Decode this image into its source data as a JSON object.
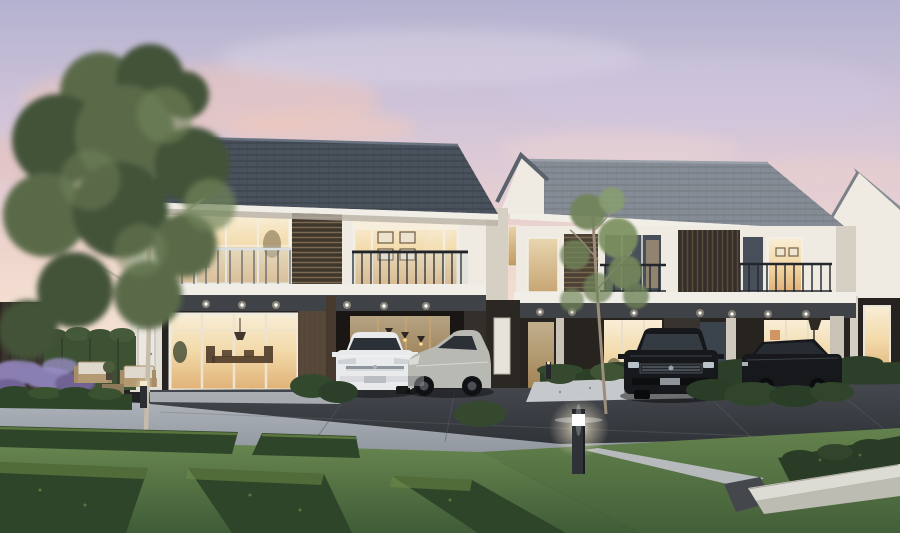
{
  "canvas": {
    "width": 900,
    "height": 533
  },
  "scene": {
    "type": "architectural-render",
    "setting": "Modern two-storey townhouse development at dusk",
    "sky": "pastel lavender-to-pink sunset with soft clouds",
    "buildings": [
      {
        "id": "building-1",
        "position": "left-foreground",
        "roof": "dark slate tiled gable",
        "floors": 2,
        "features": [
          "glass balustrade balcony",
          "timber louver screens",
          "lit upper windows",
          "gallery wall with four picture frames",
          "sliding glass doors with lit dining room",
          "carport with two cars",
          "white side door"
        ]
      },
      {
        "id": "building-2",
        "position": "right-background",
        "roof": "grey tiled gable",
        "floors": 2,
        "features": [
          "dark metal balcony railings",
          "vertical louver panel",
          "lit ground-floor glazing with floor lamp",
          "white gable end with small lit window"
        ]
      },
      {
        "id": "building-3",
        "position": "far-right-edge",
        "roof": "grey gable",
        "floors": 2,
        "features": [
          "white gable wall",
          "dark carport",
          "lit entry door"
        ]
      }
    ],
    "vehicles": [
      {
        "id": "white-sedan",
        "color": "white",
        "location": "building-1 carport",
        "orientation": "front"
      },
      {
        "id": "silver-hatchback",
        "color": "silver",
        "location": "building-1 carport",
        "orientation": "three-quarter front"
      },
      {
        "id": "black-suv",
        "color": "black",
        "location": "building-2 driveway",
        "orientation": "front"
      },
      {
        "id": "black-sedan",
        "color": "black",
        "location": "building-2 driveway",
        "orientation": "side"
      }
    ],
    "landscape": [
      "large deciduous tree",
      "slender young tree",
      "ivy hedge wall",
      "dark timber fence",
      "lavender shrubs",
      "timber garden bench set with coffee table",
      "low clipped hedges",
      "geometric hedge parterre with lawn paths",
      "gravel bed with shrubs",
      "white concrete planter",
      "concrete footpath",
      "lit bollard lamp",
      "small bollard lights",
      "recessed soffit downlights"
    ]
  },
  "palette": {
    "sky-top": "#b4b2d0",
    "sky-horizon": "#f4e0d2",
    "cloud-pink": "#eec6bb",
    "roof-dark": "#4a525e",
    "roof-light": "#868c95",
    "fascia": "#f1eee7",
    "wall-white": "#efebe2",
    "wall-shade": "#d6d0c4",
    "panel-dark": "#37332e",
    "panel-brown": "#5c4c3c",
    "window-warm": "#f2d9a8",
    "glass-cool": "#47505a",
    "canopy": "#3f4246",
    "road-light": "#a4aab2",
    "drive-dark": "#3c4046",
    "path": "#b7babd",
    "planter": "#dddcd4",
    "grass": "#5d7a46",
    "hedge": "#2f4529",
    "hedge-light": "#6d8a47",
    "tree-dark": "#435239",
    "tree-mid": "#5a6b4a",
    "tree-light": "#71845a",
    "trunk": "#c6bcab",
    "lavender": "#8a7fb0",
    "fence": "#3a332d",
    "car-white": "#e9eaec",
    "car-silver": "#b9b9b3",
    "car-black": "#16181b",
    "car-glass": "#2c3137",
    "lamp-glow": "#ffefc9"
  }
}
